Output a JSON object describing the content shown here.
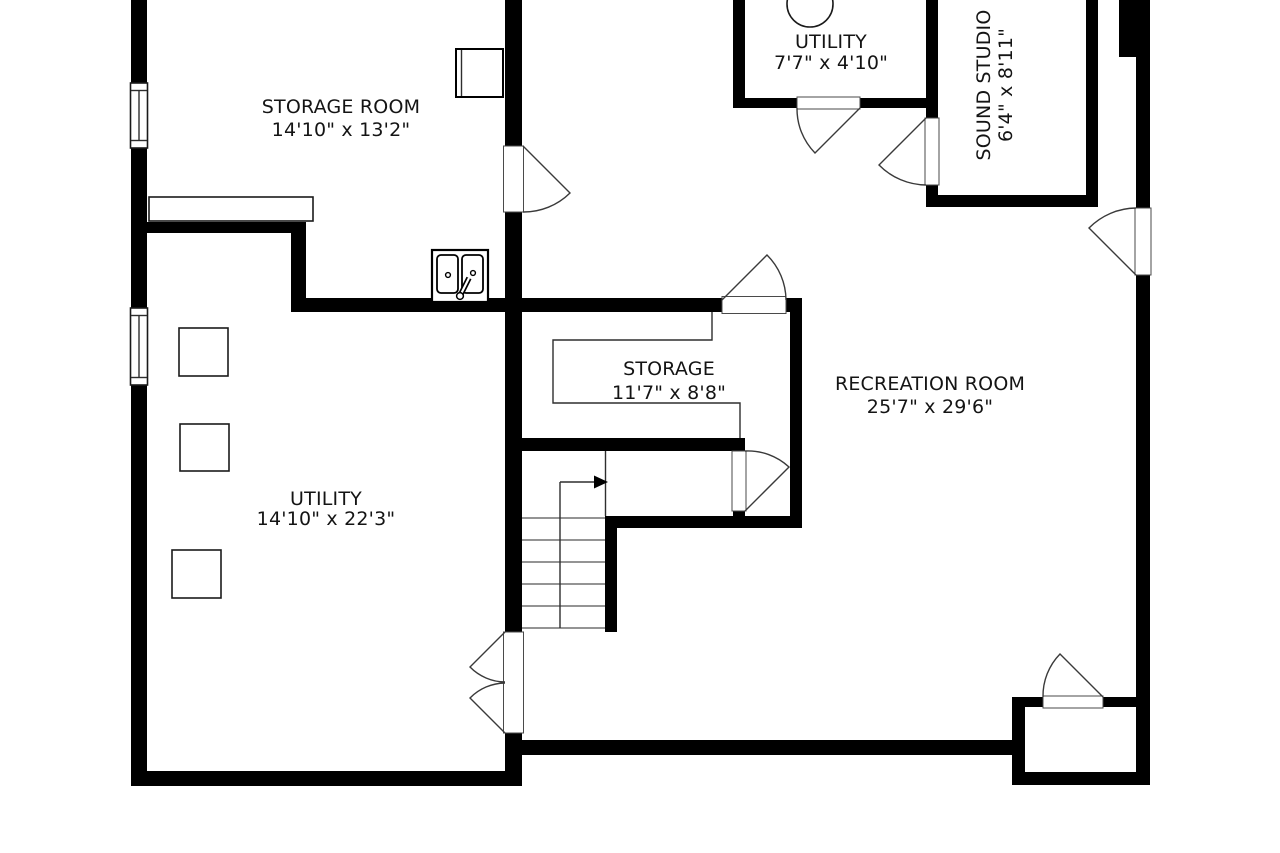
{
  "floor_plan": {
    "type": "architectural-floor-plan",
    "colors": {
      "wall": "#000000",
      "background": "#ffffff",
      "text": "#141414"
    },
    "rooms": [
      {
        "name": "STORAGE ROOM",
        "dimensions": "14'10\" x 13'2\""
      },
      {
        "name": "UTILITY",
        "dimensions": "7'7\" x 4'10\""
      },
      {
        "name": "SOUND STUDIO",
        "dimensions": "6'4\" x 8'11\""
      },
      {
        "name": "STORAGE",
        "dimensions": "11'7\" x 8'8\""
      },
      {
        "name": "RECREATION ROOM",
        "dimensions": "25'7\" x 29'6\""
      },
      {
        "name": "UTILITY",
        "dimensions": "14'10\" x 22'3\""
      }
    ]
  }
}
